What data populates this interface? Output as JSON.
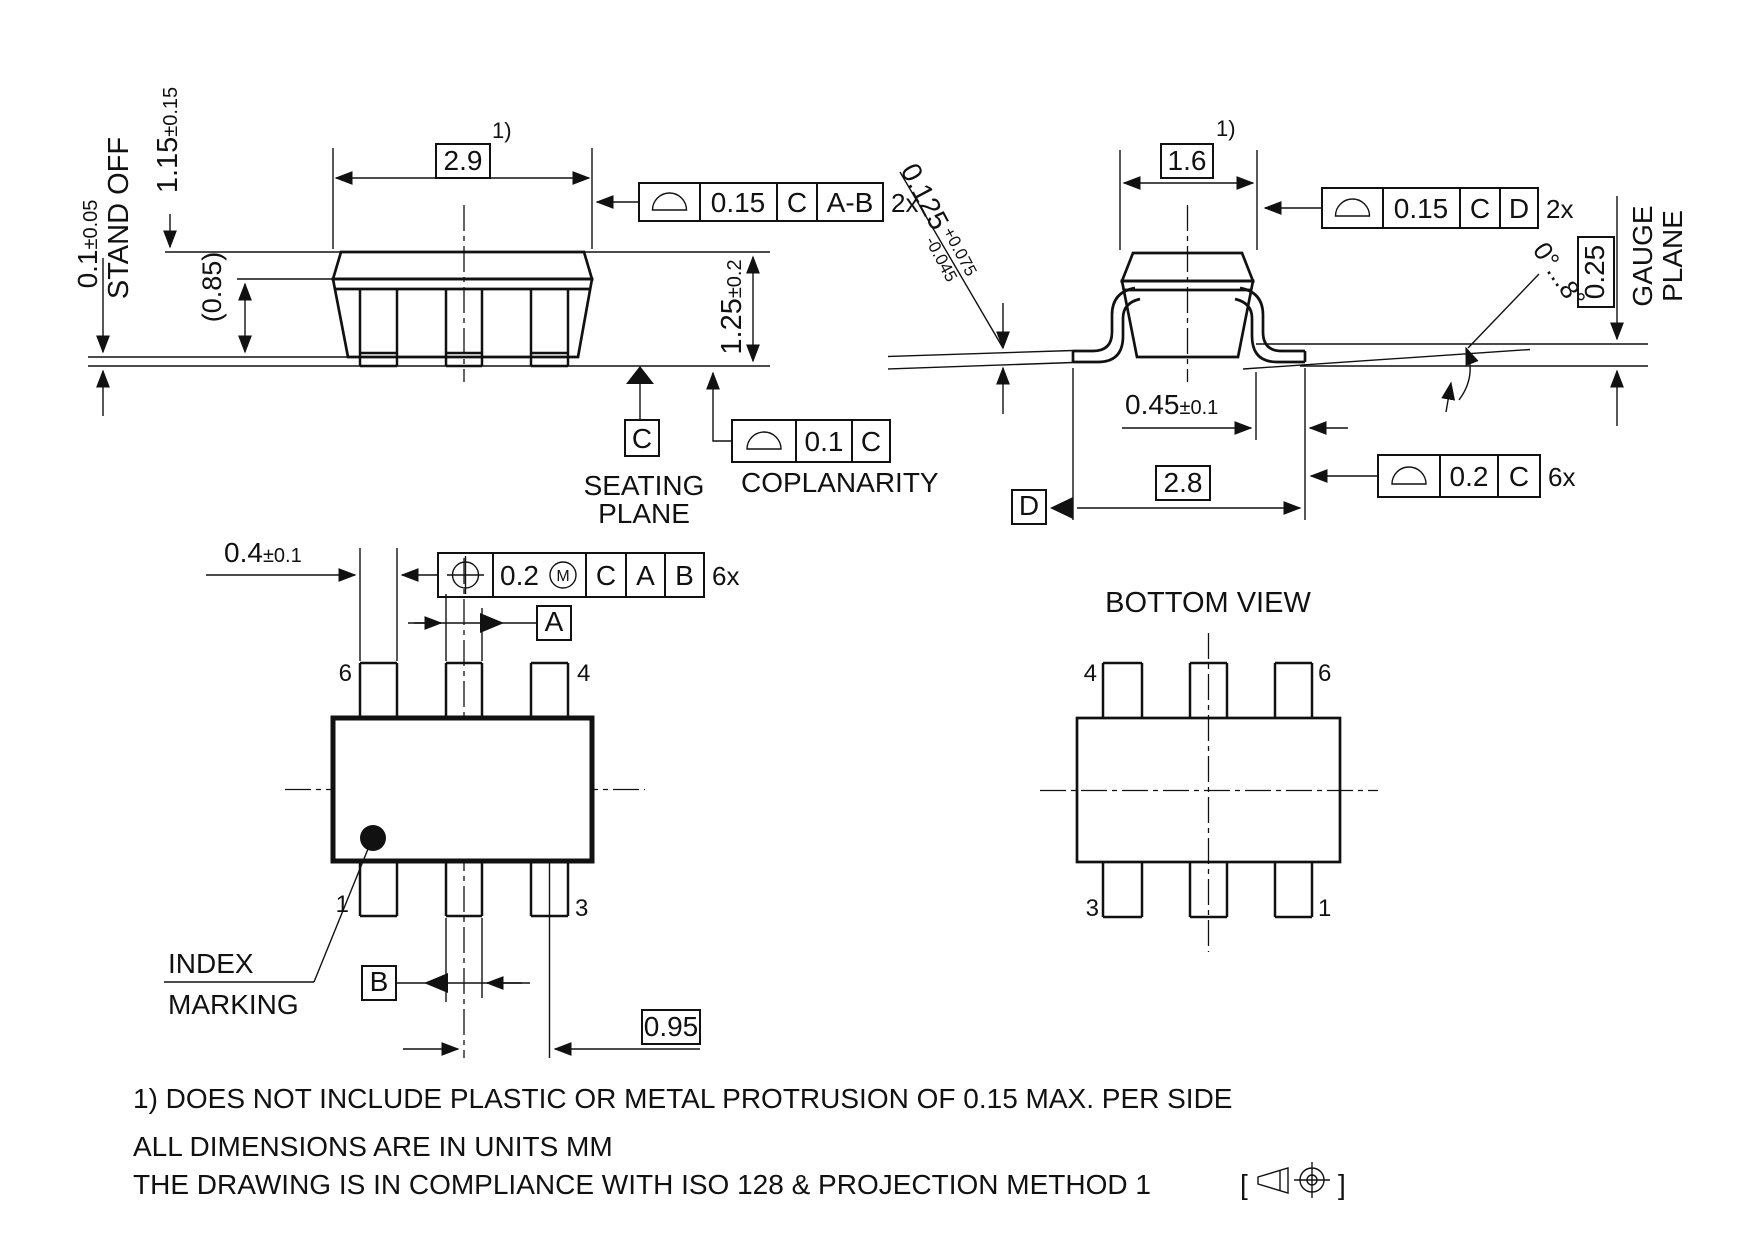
{
  "colors": {
    "line": "#111111",
    "background": "#ffffff"
  },
  "side_view": {
    "dim_width": {
      "value": "2.9",
      "note": "1)"
    },
    "dim_height": {
      "value": "1.15",
      "tol": "±0.15"
    },
    "dim_standoff": {
      "value": "0.1",
      "tol": "±0.05",
      "label": "STAND OFF"
    },
    "dim_body": {
      "value": "(0.85)"
    },
    "dim_total": {
      "value": "1.25",
      "tol": "±0.2"
    },
    "fcf_top": {
      "tolerance": "0.15",
      "datum_primary": "C",
      "datum_secondary": "A-B",
      "count": "2x"
    },
    "fcf_coplanarity": {
      "tolerance": "0.1",
      "datum": "C",
      "label": "COPLANARITY"
    },
    "seating_plane": {
      "line1": "SEATING",
      "line2": "PLANE"
    },
    "datum_c": "C"
  },
  "end_view": {
    "dim_width": {
      "value": "1.6",
      "note": "1)"
    },
    "dim_lead_thickness": {
      "value": "0.125",
      "tol_plus": "+0.075",
      "tol_minus": "-0.045"
    },
    "fcf_top": {
      "tolerance": "0.15",
      "datum_primary": "C",
      "datum_secondary": "D",
      "count": "2x"
    },
    "angle": "0°...8°",
    "gauge_plane": {
      "value": "0.25",
      "line1": "GAUGE",
      "line2": "PLANE"
    },
    "dim_lead_width": {
      "value": "0.45",
      "tol": "±0.1"
    },
    "dim_span": {
      "value": "2.8"
    },
    "datum_d": "D",
    "fcf_lead": {
      "tolerance": "0.2",
      "datum": "C",
      "count": "6x"
    }
  },
  "top_view": {
    "dim_lead": {
      "value": "0.4",
      "tol": "±0.1"
    },
    "fcf_position": {
      "tolerance": "0.2",
      "modifier": "M",
      "datum1": "C",
      "datum2": "A",
      "datum3": "B",
      "count": "6x"
    },
    "datum_a": "A",
    "datum_b": "B",
    "dim_pitch": {
      "value": "0.95"
    },
    "pins": {
      "top_left": "6",
      "top_right": "4",
      "bottom_left": "1",
      "bottom_right": "3"
    },
    "index_marking": {
      "line1": "INDEX",
      "line2": "MARKING"
    }
  },
  "bottom_view": {
    "title": "BOTTOM VIEW",
    "pins": {
      "top_left": "4",
      "top_right": "6",
      "bottom_left": "3",
      "bottom_right": "1"
    }
  },
  "notes": {
    "line1": "1) DOES NOT INCLUDE PLASTIC OR METAL PROTRUSION OF 0.15 MAX. PER SIDE",
    "line2": "ALL DIMENSIONS ARE IN UNITS MM",
    "line3": "THE DRAWING IS IN COMPLIANCE WITH ISO 128 & PROJECTION METHOD 1",
    "bracket_open": "[",
    "bracket_close": "]"
  }
}
